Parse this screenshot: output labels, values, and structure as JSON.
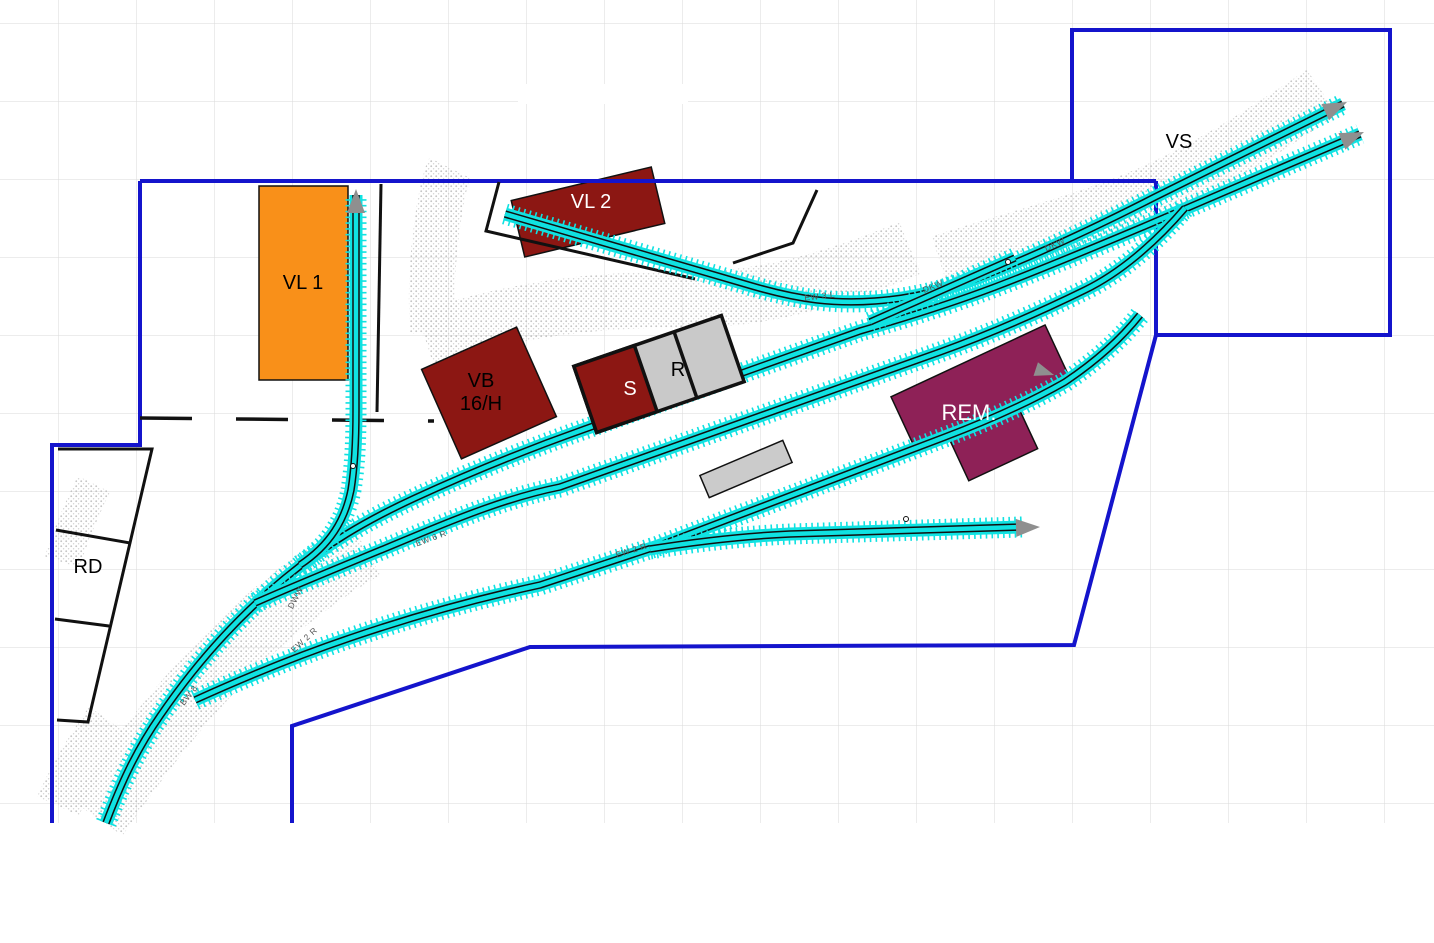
{
  "labels": {
    "vs": "VS",
    "rd": "RD"
  },
  "buildings": {
    "vl1": {
      "label": "VL 1",
      "color": "#F99019"
    },
    "vl2": {
      "label": "VL 2",
      "color": "#8C1713"
    },
    "vb": {
      "label_line1": "VB",
      "label_line2": "16/H",
      "color": "#8C1713"
    },
    "s": {
      "label": "S",
      "color": "#8C1713"
    },
    "r": {
      "label": "R",
      "color": "#C9C9C9"
    },
    "rem": {
      "label": "REM.",
      "color": "#8E2157"
    }
  },
  "track_labels": [
    "BW 8",
    "DWW",
    "EW 2 R",
    "EW 6 R",
    "EW 2 R",
    "EW 3 L",
    "DKW",
    "DKW"
  ],
  "colors": {
    "track": "#10E2E2",
    "boundary": "#1414CC",
    "grid": "#DADADA",
    "arrow": "#8F8F8F",
    "black_line": "#111111",
    "gray_block": "#C9C9C9"
  }
}
